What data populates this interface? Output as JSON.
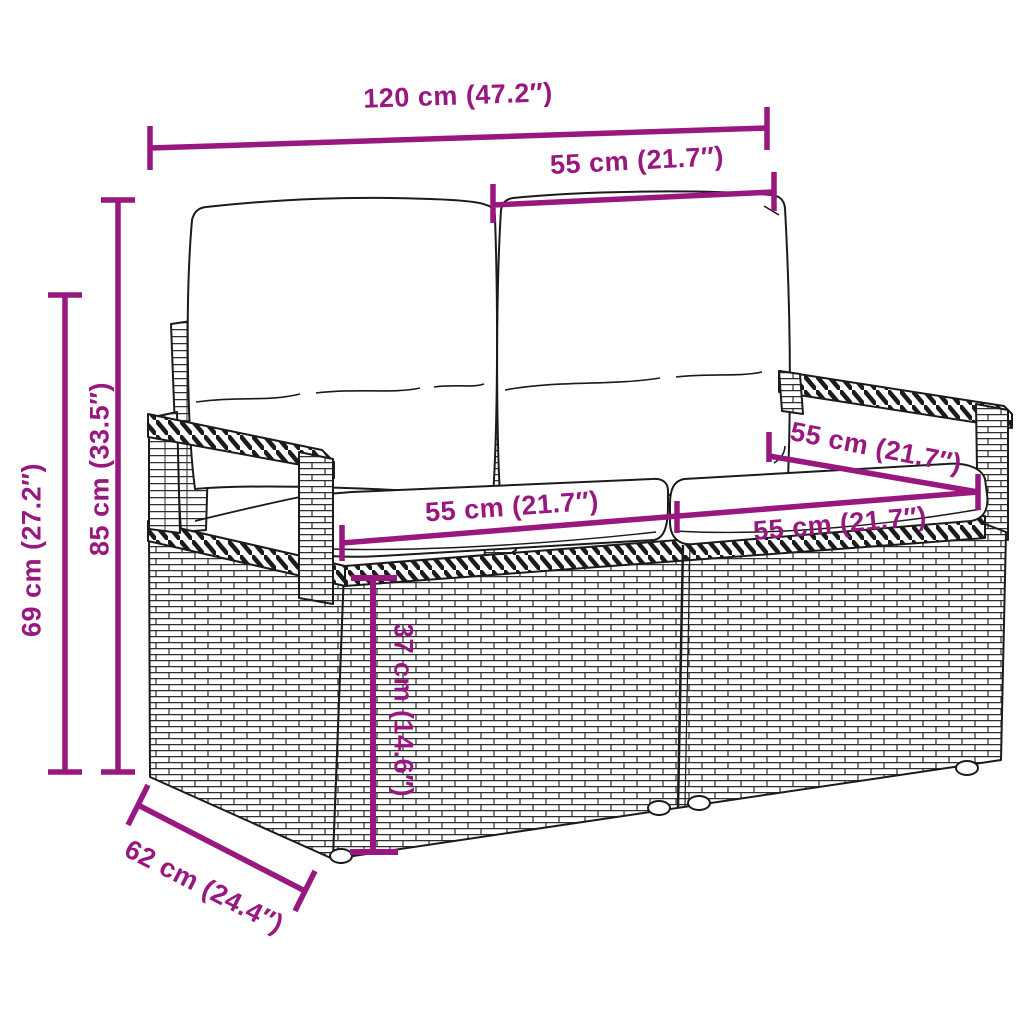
{
  "diagram": {
    "product": "poly-rattan-2-seater-garden-sofa-with-cushions",
    "style": "technical line drawing with dimension annotations",
    "accent_color": "#98187f",
    "line_color": "#1b1b1b",
    "background_color": "#ffffff",
    "dimensions": {
      "overall_width": "120 cm (47.2″)",
      "seat_width_top": "55 cm (21.7″)",
      "overall_height": "85 cm (33.5″)",
      "armrest_height": "69 cm (27.2″)",
      "seat_width_left": "55 cm (21.7″)",
      "seat_width_right": "55 cm (21.7″)",
      "backrest_width_right": "55 cm (21.7″)",
      "seat_height": "37 cm (14.6″)",
      "depth": "62 cm (24.4″)"
    }
  }
}
